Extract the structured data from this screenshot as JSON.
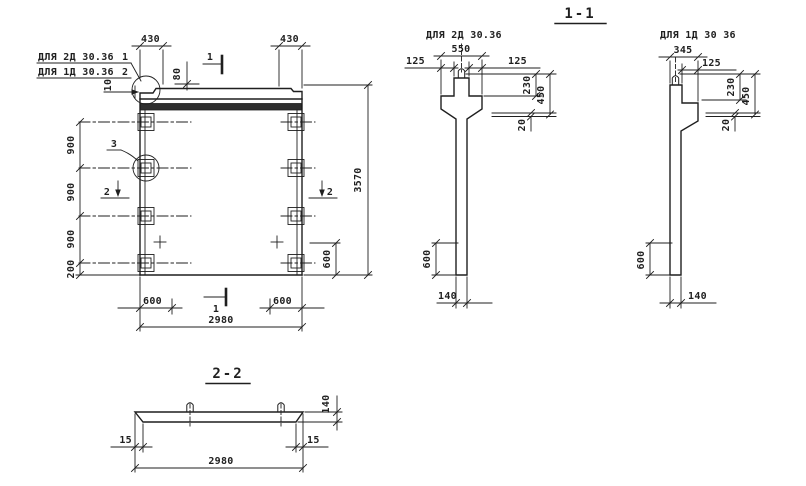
{
  "titles": {
    "section11": "1-1",
    "section22": "2-2"
  },
  "callout": {
    "line1_label": "ДЛЯ 2Д 30.36",
    "line1_ref": "1",
    "line2_label": "ДЛЯ 1Д 30.36",
    "line2_ref": "2",
    "detail_ref": "3"
  },
  "marks": {
    "cut1_top": "1",
    "cut1_bottom": "1",
    "cut2_left": "2",
    "cut2_right": "2"
  },
  "elev": {
    "d430_left": "430",
    "d430_right": "430",
    "d80": "80",
    "d10": "10",
    "d900_a": "900",
    "d900_b": "900",
    "d900_c": "900",
    "d200": "200",
    "d3570": "3570",
    "d600_right": "600",
    "d600_bottom_left": "600",
    "d600_bottom_right": "600",
    "d2980": "2980"
  },
  "p2d": {
    "label": "ДЛЯ 2Д 30.36",
    "d550": "550",
    "d125_l": "125",
    "d125_r": "125",
    "d230": "230",
    "d450": "450",
    "d20": "20",
    "d600": "600",
    "d140": "140"
  },
  "p1d": {
    "label": "ДЛЯ 1Д 30 36",
    "d345": "345",
    "d125": "125",
    "d230": "230",
    "d450": "450",
    "d20": "20",
    "d600": "600",
    "d140": "140"
  },
  "plan": {
    "d15_l": "15",
    "d15_r": "15",
    "d2980": "2980",
    "d140": "140"
  },
  "colors": {
    "ink": "#1f1f1f",
    "paper": "#ffffff"
  }
}
